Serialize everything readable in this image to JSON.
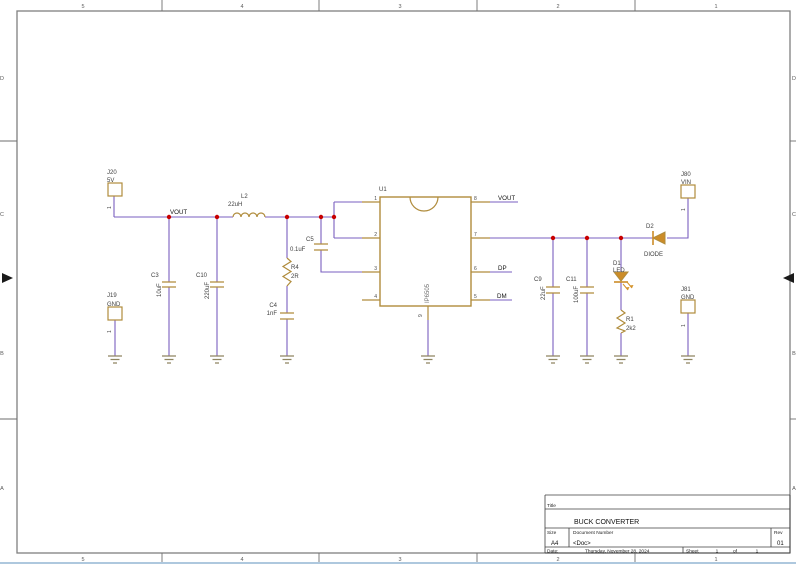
{
  "sheet": {
    "zone_cols": [
      "5",
      "4",
      "3",
      "2",
      "1"
    ],
    "zone_rows": [
      "D",
      "C",
      "B",
      "A"
    ]
  },
  "title_block": {
    "title_label": "Title",
    "title": "BUCK CONVERTER",
    "size_label": "Size",
    "size": "A4",
    "doc_label": "Document Number",
    "doc": "<Doc>",
    "rev_label": "Rev",
    "rev": "01",
    "date_label": "Date:",
    "date": "Thursday, November 28, 2024",
    "sheet_label": "Sheet",
    "sheet_num": "1",
    "of_label": "of",
    "sheet_total": "1"
  },
  "nets": {
    "vout_rail": "VOUT",
    "vout": "VOUT",
    "dp": "DP",
    "dm": "DM"
  },
  "components": {
    "J20": {
      "ref": "J20",
      "value": "5V",
      "pin": "1"
    },
    "J19": {
      "ref": "J19",
      "value": "GND",
      "pin": "1"
    },
    "J80": {
      "ref": "J80",
      "value": "VIN",
      "pin": "1"
    },
    "J81": {
      "ref": "J81",
      "value": "GND",
      "pin": "1"
    },
    "L2": {
      "ref": "L2",
      "value": "22uH"
    },
    "C3": {
      "ref": "C3",
      "value": "10uF"
    },
    "C10": {
      "ref": "C10",
      "value": "220uF"
    },
    "C5": {
      "ref": "C5",
      "value": "0.1uF"
    },
    "C4": {
      "ref": "C4",
      "value": "1nF"
    },
    "R4": {
      "ref": "R4",
      "value": "2R"
    },
    "C9": {
      "ref": "C9",
      "value": "22uF"
    },
    "C11": {
      "ref": "C11",
      "value": "100uF"
    },
    "D1": {
      "ref": "D1",
      "value": "LED"
    },
    "R1": {
      "ref": "R1",
      "value": "2k2"
    },
    "D2": {
      "ref": "D2",
      "value": "DIODE"
    },
    "U1": {
      "ref": "U1",
      "value": "IP6505",
      "pins": {
        "p1": "1",
        "p2": "2",
        "p3": "3",
        "p4": "4",
        "p5": "5",
        "p6": "6",
        "p7": "7",
        "p8": "8",
        "p9": "9"
      }
    }
  },
  "colors": {
    "wire": "#7a5fc0",
    "junction": "#c80000",
    "component_outline": "#b08c3c",
    "device_fill": "#cc8c28",
    "frame": "#7f7f7f"
  }
}
